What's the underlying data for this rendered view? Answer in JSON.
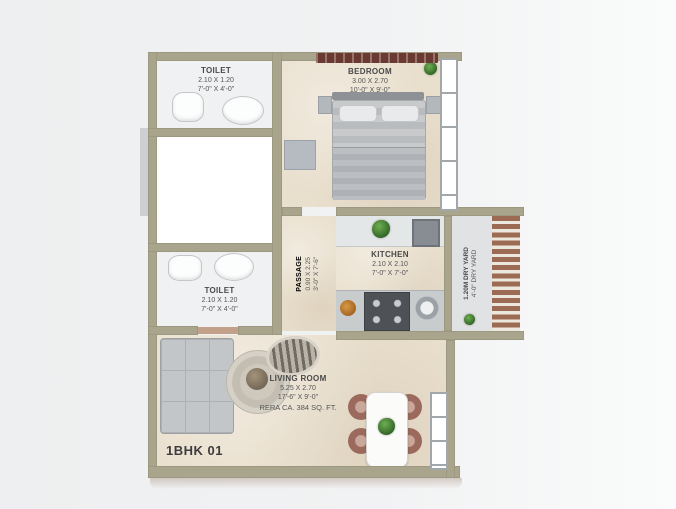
{
  "unit": {
    "label": "1BHK 01"
  },
  "rooms": {
    "toilet_top": {
      "name": "TOILET",
      "dim_m": "2.10 X 1.20",
      "dim_ft": "7'-0\" X 4'-0\""
    },
    "bedroom": {
      "name": "BEDROOM",
      "dim_m": "3.00 X 2.70",
      "dim_ft": "10'-0\" X 9'-0\""
    },
    "passage": {
      "name": "PASSAGE",
      "dim_m": "0.90 X 2.25",
      "dim_ft": "3'-0\" X 7'-6\""
    },
    "kitchen": {
      "name": "KITCHEN",
      "dim_m": "2.10 X 2.10",
      "dim_ft": "7'-0\" X 7'-0\""
    },
    "dry_yard": {
      "line1": "1.20M DRY YARD",
      "line2": "4'-0\" DRY YARD"
    },
    "toilet_mid": {
      "name": "TOILET",
      "dim_m": "2.10 X 1.20",
      "dim_ft": "7'-0\" X 4'-0\""
    },
    "living_room": {
      "name": "LIVING ROOM",
      "dim_m": "5.25 X 2.70",
      "dim_ft": "17'-6\" X 9'-0\"",
      "rera": "RERA CA. 384 SQ. FT."
    }
  },
  "colors": {
    "wall": "#a9a48c",
    "floor_beige": "#e9dfcd",
    "floor_white": "#eff1f2",
    "louver_wood": "#9c6b53",
    "shelf_dark": "#6a3a30",
    "label_text": "#4a4a4a",
    "background": "#f1f2f3"
  }
}
